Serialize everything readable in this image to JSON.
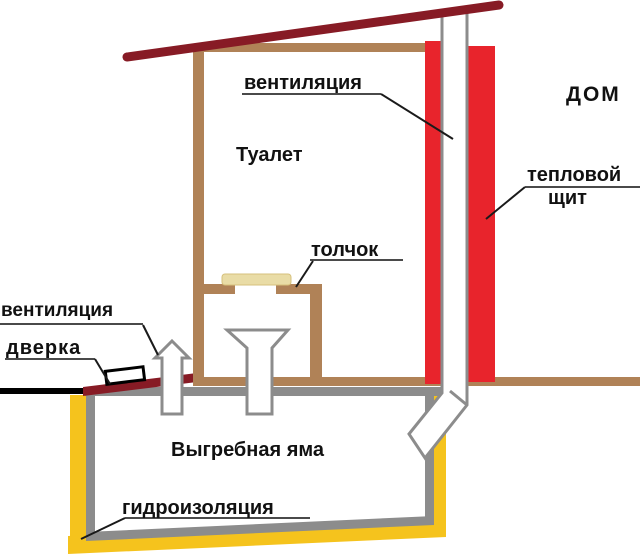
{
  "diagram": {
    "labels": {
      "ventilation_top": "вентиляция",
      "house": "ДОМ",
      "toilet_room": "Туалет",
      "heat_shield_line1": "тепловой",
      "heat_shield_line2": "щит",
      "toilet_seat": "толчок",
      "ventilation_left": "вентиляция",
      "door": "дверка",
      "cesspool": "Выгребная яма",
      "waterproofing": "гидроизоляция"
    },
    "colors": {
      "roof_dark_red": "#871b25",
      "heat_shield_red": "#e8242c",
      "wall_brown": "#b08257",
      "pit_gray": "#8c8c8c",
      "waterproofing_yellow": "#f5c31d",
      "seat_lid_beige": "#e9dca6",
      "seat_lid_border": "#d6c07c",
      "ground_black": "#000000",
      "pipe_white": "#ffffff",
      "pointer_black": "#1a1a1a",
      "underline_gray": "#4a4a4a"
    }
  }
}
